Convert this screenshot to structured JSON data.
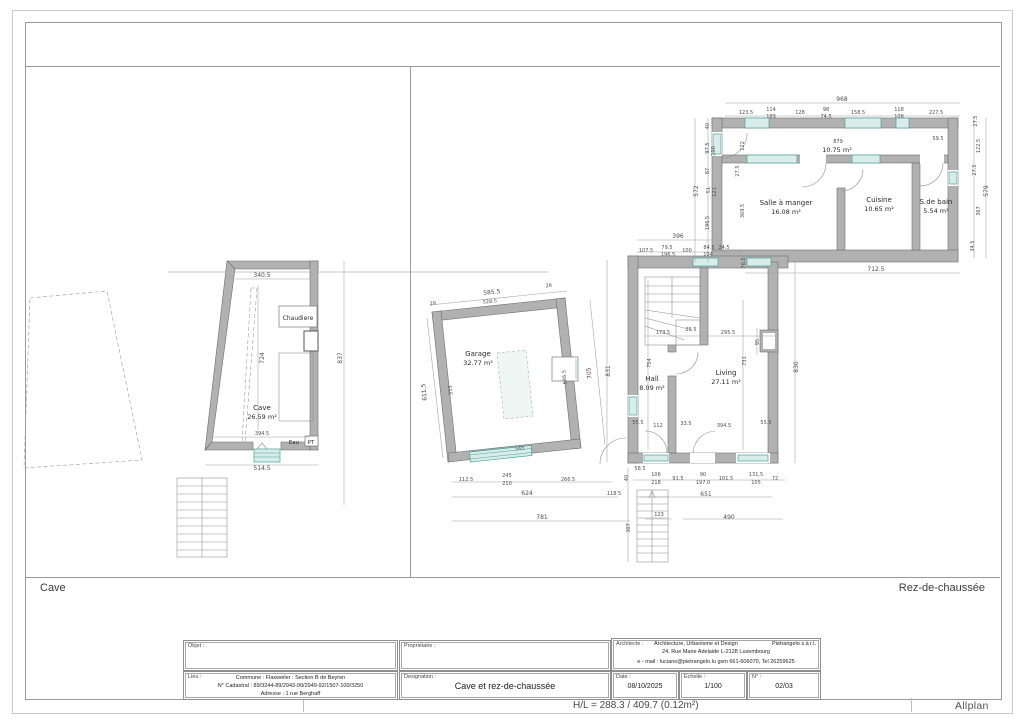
{
  "window": {
    "status_left": "H/L = 288.3 / 409.7 (0.12m²)",
    "brand": "Allplan"
  },
  "sheet": {
    "pane_left_label": "Cave",
    "pane_right_label": "Rez-de-chaussée"
  },
  "title_block": {
    "objet": {
      "label": "Objet :",
      "value": ""
    },
    "proprietaire": {
      "label": "Proprietaire :",
      "value": ""
    },
    "architecte": {
      "label": "Architecte :",
      "line1_left": "Architecture, Urbanisme et Design",
      "line1_right": "Pietrangelo   s.à r.l.",
      "line2": "24, Rue Marie Adelaide   L-2128   Luxembourg",
      "line3": "e - mail : luciano@pietrangelo.lu   gsm 661-606070, Tel 26259625"
    },
    "lieu": {
      "label": "Lieu :",
      "line1": "Commune : Flaxweiler : Section B de Beyren",
      "line2": "N° Cadastral : 89/3244-89/2943-90/2949-92/1507-100/3250",
      "line3": "Adresse : 1 rue Berghaff"
    },
    "designation": {
      "label": "Designation :",
      "value": "Cave et rez-de-chaussée"
    },
    "date": {
      "label": "Date :",
      "value": "08/10/2025"
    },
    "echelle": {
      "label": "Echelle :",
      "value": "1/100"
    },
    "numero": {
      "label": "N° :",
      "value": "02/03"
    }
  },
  "drawing": {
    "rooms": [
      {
        "name": "Cave",
        "area": "26.59 m²",
        "x": 262,
        "y": 410
      },
      {
        "name": "Garage",
        "area": "32.77 m²",
        "x": 478,
        "y": 356
      },
      {
        "name": "",
        "area": "10.75 m²",
        "x": 837,
        "y": 152
      },
      {
        "name": "Salle à manger",
        "area": "16.08 m²",
        "x": 786,
        "y": 205
      },
      {
        "name": "Cuisine",
        "area": "10.65 m²",
        "x": 879,
        "y": 202
      },
      {
        "name": "S.de bain",
        "area": "5.54 m²",
        "x": 936,
        "y": 204
      },
      {
        "name": "Living",
        "area": "27.11 m²",
        "x": 726,
        "y": 375
      },
      {
        "name": "Hall",
        "area": "8.09 m²",
        "x": 652,
        "y": 381
      }
    ],
    "texts": [
      {
        "t": "Chaudiere",
        "x": 298,
        "y": 320,
        "s": 6,
        "c": "lbl"
      },
      {
        "t": "Eau",
        "x": 294,
        "y": 444,
        "s": 5.5,
        "c": "lbl"
      },
      {
        "t": "PT",
        "x": 311,
        "y": 444,
        "s": 5.5,
        "c": "lbl"
      },
      {
        "t": "340.5",
        "x": 262,
        "y": 277
      },
      {
        "t": "724",
        "x": 264,
        "y": 358,
        "r": -90
      },
      {
        "t": "394.5",
        "x": 262,
        "y": 435,
        "s": 5
      },
      {
        "t": "514.5",
        "x": 262,
        "y": 470
      },
      {
        "t": "837",
        "x": 342,
        "y": 358,
        "r": -90
      },
      {
        "t": "968",
        "x": 842,
        "y": 101
      },
      {
        "t": "123.5",
        "x": 746,
        "y": 114,
        "s": 5
      },
      {
        "t": "114",
        "x": 771,
        "y": 111,
        "s": 5
      },
      {
        "t": "189",
        "x": 771,
        "y": 118,
        "s": 5
      },
      {
        "t": "128",
        "x": 800,
        "y": 114,
        "s": 5
      },
      {
        "t": "98",
        "x": 826,
        "y": 111,
        "s": 5
      },
      {
        "t": "74.5",
        "x": 826,
        "y": 118,
        "s": 5
      },
      {
        "t": "158.5",
        "x": 858,
        "y": 114,
        "s": 5
      },
      {
        "t": "118",
        "x": 899,
        "y": 111,
        "s": 5
      },
      {
        "t": "108",
        "x": 899,
        "y": 118,
        "s": 5
      },
      {
        "t": "227.5",
        "x": 936,
        "y": 114,
        "s": 5
      },
      {
        "t": "40",
        "x": 709,
        "y": 126,
        "r": -90,
        "s": 5
      },
      {
        "t": "97.5",
        "x": 709,
        "y": 148,
        "r": -90,
        "s": 5
      },
      {
        "t": "190",
        "x": 715,
        "y": 151,
        "r": -90,
        "s": 5
      },
      {
        "t": "87",
        "x": 709,
        "y": 171,
        "r": -90,
        "s": 5
      },
      {
        "t": "572",
        "x": 698,
        "y": 191,
        "r": -90
      },
      {
        "t": "51",
        "x": 710,
        "y": 190,
        "r": -90,
        "s": 5
      },
      {
        "t": "121",
        "x": 716,
        "y": 192,
        "r": -90,
        "s": 5
      },
      {
        "t": "196.5",
        "x": 709,
        "y": 223,
        "r": -90,
        "s": 5
      },
      {
        "t": "27.5",
        "x": 739,
        "y": 171,
        "r": -90,
        "s": 5
      },
      {
        "t": "122",
        "x": 744,
        "y": 146,
        "r": -90,
        "s": 5
      },
      {
        "t": "369.5",
        "x": 744,
        "y": 211,
        "r": -90,
        "s": 5
      },
      {
        "t": "879",
        "x": 838,
        "y": 143,
        "s": 5
      },
      {
        "t": "59.5",
        "x": 938,
        "y": 140,
        "s": 5
      },
      {
        "t": "27.5",
        "x": 977,
        "y": 121,
        "r": -90,
        "s": 5
      },
      {
        "t": "122.5",
        "x": 980,
        "y": 146,
        "r": -90,
        "s": 5
      },
      {
        "t": "27.5",
        "x": 976,
        "y": 170,
        "r": -90,
        "s": 5
      },
      {
        "t": "579",
        "x": 988,
        "y": 191,
        "r": -90
      },
      {
        "t": "367",
        "x": 980,
        "y": 211,
        "r": -90,
        "s": 5
      },
      {
        "t": "34.5",
        "x": 974,
        "y": 246,
        "r": -90,
        "s": 5
      },
      {
        "t": "712.5",
        "x": 876,
        "y": 271
      },
      {
        "t": "396",
        "x": 678,
        "y": 238
      },
      {
        "t": "107.5",
        "x": 646,
        "y": 252,
        "s": 5
      },
      {
        "t": "79.5",
        "x": 667,
        "y": 249,
        "s": 5
      },
      {
        "t": "196.5",
        "x": 668,
        "y": 256,
        "s": 5
      },
      {
        "t": "100",
        "x": 687,
        "y": 252,
        "s": 5
      },
      {
        "t": "84.5",
        "x": 709,
        "y": 249,
        "s": 5
      },
      {
        "t": "104",
        "x": 708,
        "y": 256,
        "s": 5
      },
      {
        "t": "24.5",
        "x": 724,
        "y": 249,
        "s": 5
      },
      {
        "t": "76.5",
        "x": 745,
        "y": 263,
        "r": -90,
        "s": 5
      },
      {
        "t": "173.5",
        "x": 663,
        "y": 334,
        "s": 5
      },
      {
        "t": "25.5",
        "x": 691,
        "y": 331,
        "s": 5
      },
      {
        "t": "295.5",
        "x": 728,
        "y": 334,
        "s": 5
      },
      {
        "t": "95",
        "x": 759,
        "y": 342,
        "r": -90,
        "s": 5
      },
      {
        "t": "754",
        "x": 651,
        "y": 363,
        "r": -90,
        "s": 5
      },
      {
        "t": "731",
        "x": 746,
        "y": 361,
        "r": -90,
        "s": 5
      },
      {
        "t": "830",
        "x": 798,
        "y": 367,
        "r": -90
      },
      {
        "t": "831",
        "x": 610,
        "y": 371,
        "r": -90
      },
      {
        "t": "55.5",
        "x": 638,
        "y": 424,
        "s": 5
      },
      {
        "t": "112",
        "x": 658,
        "y": 427,
        "s": 5
      },
      {
        "t": "33.5",
        "x": 686,
        "y": 425,
        "s": 5
      },
      {
        "t": "394.5",
        "x": 724,
        "y": 427,
        "s": 5
      },
      {
        "t": "55.5",
        "x": 766,
        "y": 424,
        "s": 5
      },
      {
        "t": "58.5",
        "x": 640,
        "y": 470,
        "s": 5
      },
      {
        "t": "40",
        "x": 628,
        "y": 478,
        "r": -90,
        "s": 5
      },
      {
        "t": "106",
        "x": 656,
        "y": 476,
        "s": 5
      },
      {
        "t": "218",
        "x": 656,
        "y": 484,
        "s": 5
      },
      {
        "t": "91.5",
        "x": 678,
        "y": 480,
        "s": 5
      },
      {
        "t": "90",
        "x": 703,
        "y": 476,
        "s": 5
      },
      {
        "t": "197.0",
        "x": 703,
        "y": 484,
        "s": 5
      },
      {
        "t": "101.5",
        "x": 726,
        "y": 480,
        "s": 5
      },
      {
        "t": "131.5",
        "x": 756,
        "y": 476,
        "s": 5
      },
      {
        "t": "105",
        "x": 756,
        "y": 484,
        "s": 5
      },
      {
        "t": "72",
        "x": 775,
        "y": 480,
        "s": 5
      },
      {
        "t": "651",
        "x": 706,
        "y": 496
      },
      {
        "t": "123",
        "x": 659,
        "y": 516,
        "s": 5
      },
      {
        "t": "490",
        "x": 729,
        "y": 519
      },
      {
        "t": "307",
        "x": 630,
        "y": 528,
        "r": -90,
        "s": 5
      },
      {
        "t": "585.5",
        "x": 492,
        "y": 294,
        "r": -6
      },
      {
        "t": "528.5",
        "x": 490,
        "y": 303,
        "r": -6,
        "s": 5
      },
      {
        "t": "29",
        "x": 433,
        "y": 305,
        "r": -6,
        "s": 5
      },
      {
        "t": "26",
        "x": 549,
        "y": 287,
        "r": -6,
        "s": 5
      },
      {
        "t": "611.5",
        "x": 426,
        "y": 392,
        "r": -96
      },
      {
        "t": "555",
        "x": 452,
        "y": 390,
        "r": -96,
        "s": 5
      },
      {
        "t": "646.5",
        "x": 566,
        "y": 377,
        "r": -96,
        "s": 5
      },
      {
        "t": "705",
        "x": 591,
        "y": 373,
        "r": -96
      },
      {
        "t": "565",
        "x": 520,
        "y": 450,
        "r": -6,
        "s": 5
      },
      {
        "t": "112.5",
        "x": 466,
        "y": 481,
        "s": 5
      },
      {
        "t": "245",
        "x": 507,
        "y": 477,
        "s": 5
      },
      {
        "t": "210",
        "x": 507,
        "y": 485,
        "s": 5
      },
      {
        "t": "266.5",
        "x": 568,
        "y": 481,
        "s": 5
      },
      {
        "t": "624",
        "x": 527,
        "y": 495
      },
      {
        "t": "118.5",
        "x": 614,
        "y": 495,
        "s": 5
      },
      {
        "t": "781",
        "x": 542,
        "y": 519
      }
    ]
  }
}
